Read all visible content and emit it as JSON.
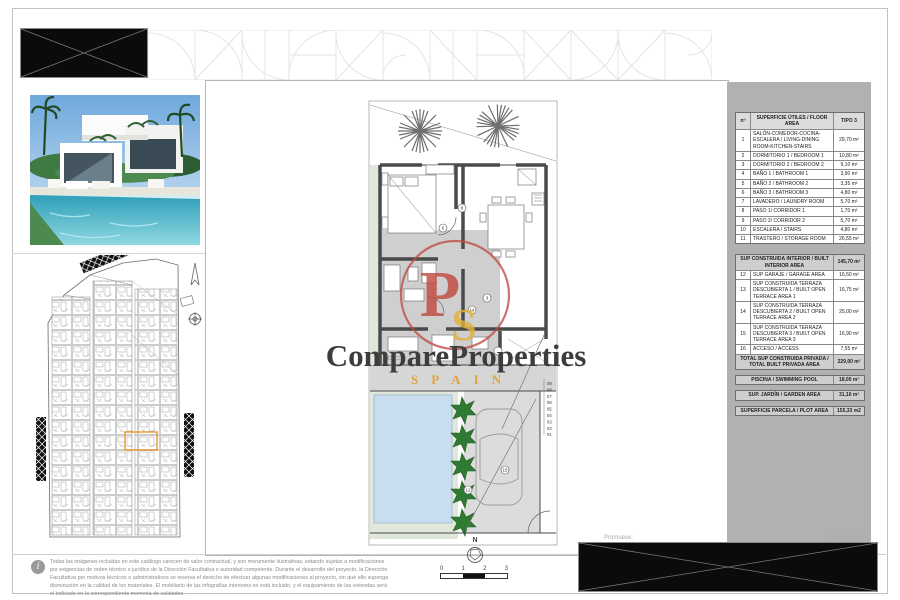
{
  "watermark": {
    "brand": "CompareProperties",
    "sub": "SPAIN",
    "monogram_p": "P",
    "monogram_s": "S"
  },
  "footer": {
    "promueve_label": "Promueve:",
    "comercializa_label": "Comercializa:",
    "north_label": "N",
    "scale_ticks": [
      "0",
      "1",
      "2",
      "3"
    ],
    "info_glyph": "i",
    "disclaimer": [
      "Todas las imágenes incluidas en este catálogo carecen de valor contractual, y son meramente ilustrativas, estando sujetas a modificaciones",
      "por exigencias de orden técnico o jurídico de la Dirección Facultativa o autoridad competente. Durante el desarrollo del proyecto, la Dirección",
      "Facultativa por motivos técnicos o administrativos se reserva el derecho de efectuar algunas modificaciones al proyecto, sin que ello suponga",
      "disminución en la calidad de los materiales. El mobiliario de las infografías interiores no está incluido, y el equipamiento de las viviendas será",
      "el indicado en la correspondiente memoria de calidades."
    ]
  },
  "area_table": {
    "col_num": "nº",
    "col_name": "SUPERFICIE ÚTILES / FLOOR AREA",
    "col_type": "TIPO 3",
    "rows": [
      {
        "num": "1",
        "name": "SALÓN-COMEDOR-COCINA-ESCALERA / LIVING-DINING ROOM-KITCHEN-STAIRS",
        "value": "29,70 m²"
      },
      {
        "num": "2",
        "name": "DORMITORIO 1 / BEDROOM 1",
        "value": "10,80 m²"
      },
      {
        "num": "3",
        "name": "DORMITORIO 2 / BEDROOM 2",
        "value": "9,10 m²"
      },
      {
        "num": "4",
        "name": "BAÑO 1 / BATHROOM 1",
        "value": "3,90 m²"
      },
      {
        "num": "5",
        "name": "BAÑO 2 / BATHROOM 2",
        "value": "3,35 m²"
      },
      {
        "num": "6",
        "name": "BAÑO 3 / BATHROOM 3",
        "value": "4,80 m²"
      },
      {
        "num": "7",
        "name": "LAVADERO / LAUNDRY ROOM",
        "value": "5,70 m²"
      },
      {
        "num": "8",
        "name": "PASO 1/ CORRIDOR 1",
        "value": "1,70 m²"
      },
      {
        "num": "9",
        "name": "PASO 2/ CORRIDOR 2",
        "value": "5,70 m²"
      },
      {
        "num": "10",
        "name": "ESCALERA / STAIRS",
        "value": "4,80 m²"
      },
      {
        "num": "11",
        "name": "TRASTERO / STORAGE ROOM",
        "value": "26,55 m²"
      }
    ],
    "interior_total": {
      "name": "SUP CONSTRUIDA INTERIOR / BUILT INTERIOR AREA",
      "value": "145,70 m²"
    },
    "rows2": [
      {
        "num": "12",
        "name": "SUP GARAJE / GARAGE AREA",
        "value": "16,50 m²"
      },
      {
        "num": "13",
        "name": "SUP CONSTRUIDA TERRAZA DESCUBIERTA 1 / BUILT OPEN TERRACE AREA 1",
        "value": "16,75 m²"
      },
      {
        "num": "14",
        "name": "SUP CONSTRUIDA TERRAZA DESCUBIERTA 2 / BUILT OPEN TERRACE AREA 2",
        "value": "25,00 m²"
      },
      {
        "num": "15",
        "name": "SUP CONSTRUIDA TERRAZA DESCUBIERTA 3 / BUILT OPEN TERRACE AREA 3",
        "value": "16,90 m²"
      },
      {
        "num": "16",
        "name": "ACCESO / ACCESS",
        "value": "7,55 m²"
      }
    ],
    "private_total": {
      "name": "TOTAL SUP CONSTRUIDA PRIVADA / TOTAL BUILT PRIVADA AREA",
      "value": "229,00 m²"
    },
    "pool": {
      "name": "PISCINA / SWIMMING POOL",
      "value": "18,00 m²"
    },
    "garden": {
      "name": "SUP. JARDÍN / GARDEN AREA",
      "value": "31,16 m²"
    },
    "plot": {
      "name": "SUPERFICIE PARCELA / PLOT AREA",
      "value": "155,33 m2"
    }
  },
  "floor_plan": {
    "step_numbers": [
      "09",
      "08",
      "07",
      "06",
      "05",
      "04",
      "03",
      "02",
      "01"
    ],
    "door_markers": [
      "8",
      "6",
      "3",
      "14",
      "12",
      "15"
    ]
  },
  "colors": {
    "accent_orange": "#E8962E",
    "watermark_red": "#BF4A3F",
    "watermark_yellow": "#E2B13C",
    "panel_gray": "#B1B1B1",
    "pool_blue": "#C9DDF0",
    "garden_green": "#DFE8DA",
    "hedge_green": "#1F5B1F"
  }
}
